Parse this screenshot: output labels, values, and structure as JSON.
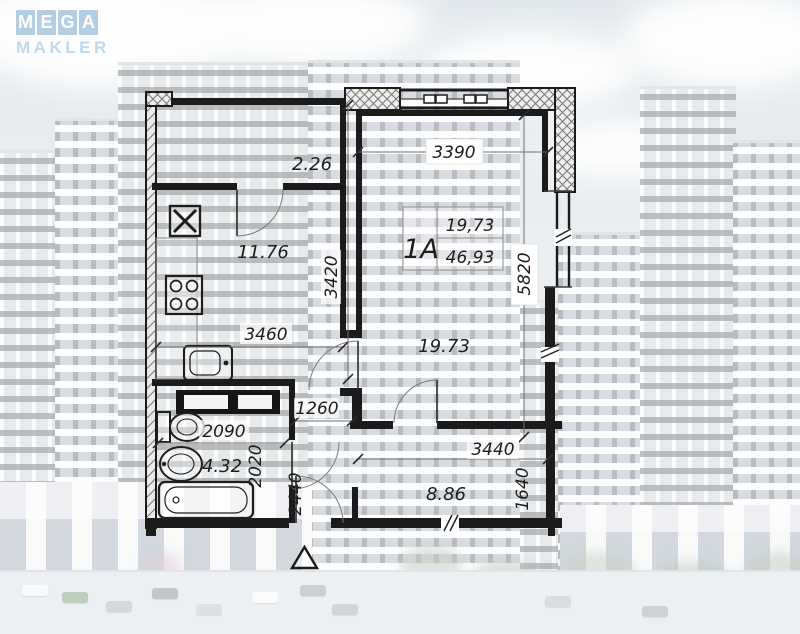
{
  "logo": {
    "letters": [
      "M",
      "E",
      "G",
      "A"
    ],
    "subtitle": "MAKLER"
  },
  "floor_plan": {
    "apartment": {
      "label": "1A",
      "living_area": "19,73",
      "total_area": "46,93"
    },
    "room_areas": {
      "hall": "2.26",
      "kitchen": "11.76",
      "living_room": "19.73",
      "bathroom": "4.32",
      "balcony": "8.86"
    },
    "dimensions_mm": {
      "living_width": "3390",
      "living_length": "5820",
      "kitchen_width": "3460",
      "hall_length": "3420",
      "corridor_width": "1260",
      "bathroom_width": "2090",
      "bathroom_length": "2020",
      "corridor_length": "2440",
      "balcony_width": "3440",
      "balcony_depth": "1640"
    }
  },
  "colors": {
    "wall": "#1b1b1b",
    "logo_tile": "#a8c7df",
    "sky": "#cdd8df"
  }
}
